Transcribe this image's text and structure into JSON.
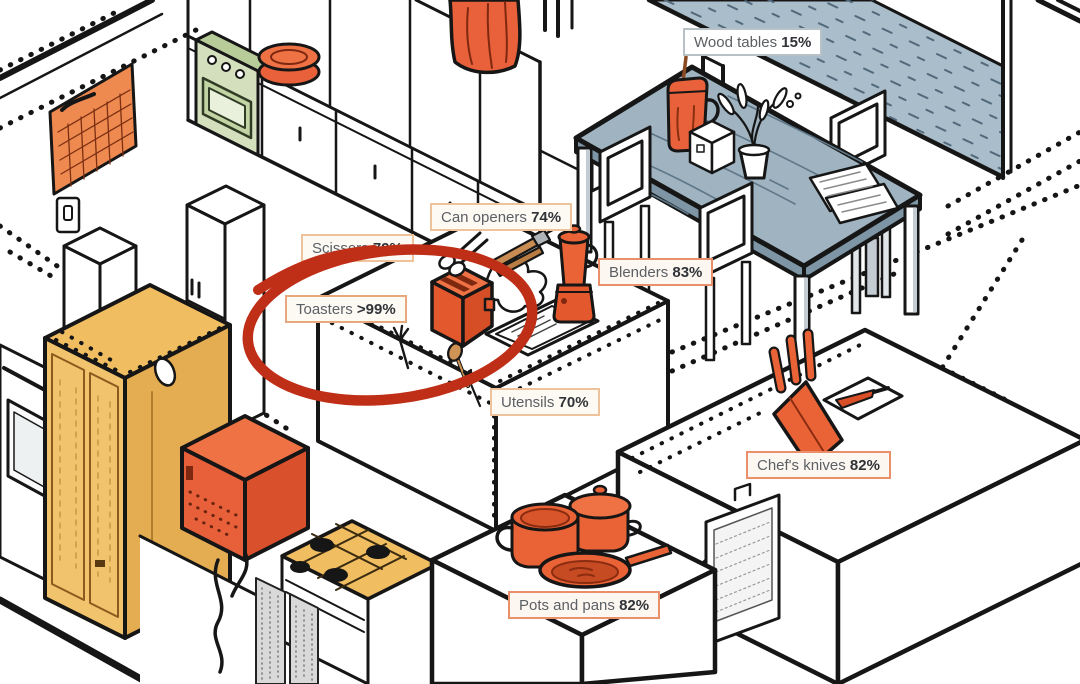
{
  "labels": [
    {
      "id": "wood-tables",
      "name": "Wood tables",
      "value": "15%"
    },
    {
      "id": "can-openers",
      "name": "Can openers",
      "value": "74%"
    },
    {
      "id": "scissors",
      "name": "Scissors",
      "value": "79%"
    },
    {
      "id": "blenders",
      "name": "Blenders",
      "value": "83%"
    },
    {
      "id": "toasters",
      "name": "Toasters",
      "value": ">99%"
    },
    {
      "id": "utensils",
      "name": "Utensils",
      "value": "70%"
    },
    {
      "id": "chefs-knives",
      "name": "Chef's knives",
      "value": "82%"
    },
    {
      "id": "pots-pans",
      "name": "Pots and pans",
      "value": "82%"
    }
  ],
  "highlighted_item": "Toasters",
  "colors": {
    "accent_orange": "#e8613a",
    "highlight_red": "#bf2e17",
    "table_blue": "#a9bdca",
    "cabinet_yellow": "#f2c36d",
    "label_border_orange": "#eec29b",
    "label_border_gray": "#b7c1c6",
    "ink": "#161616"
  },
  "chart_data": {
    "type": "table",
    "title": "",
    "categories": [
      "Wood tables",
      "Can openers",
      "Scissors",
      "Blenders",
      "Toasters",
      "Utensils",
      "Chef's knives",
      "Pots and pans"
    ],
    "values": [
      "15%",
      "74%",
      "79%",
      "83%",
      ">99%",
      "70%",
      "82%",
      "82%"
    ]
  }
}
